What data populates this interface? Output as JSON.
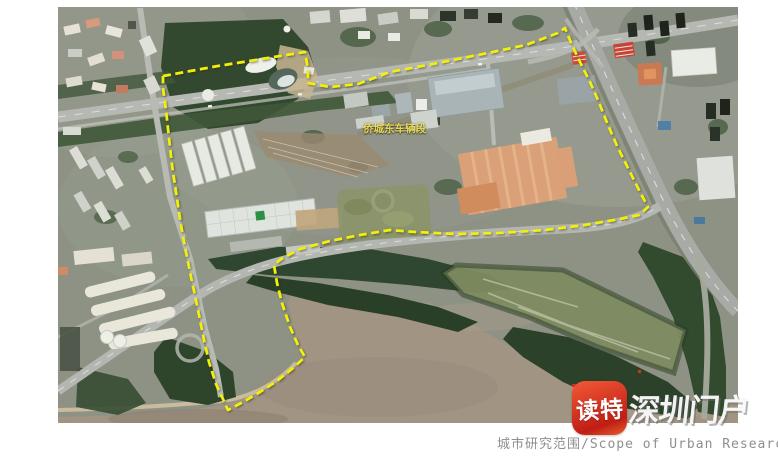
{
  "map": {
    "x": 58,
    "y": 7,
    "width": 680,
    "height": 416,
    "kind": "satellite-imagery",
    "place_label": {
      "text": "侨城东车辆段",
      "color": "#f3e24a"
    }
  },
  "boundary": {
    "label": "城市研究范围",
    "color": "#f2ef0c",
    "stroke_width": 2.8,
    "dash": "8 4.5",
    "points": [
      [
        105,
        69
      ],
      [
        160,
        59
      ],
      [
        210,
        51
      ],
      [
        247,
        45
      ],
      [
        250,
        62
      ],
      [
        250,
        76
      ],
      [
        272,
        80
      ],
      [
        300,
        77
      ],
      [
        332,
        65
      ],
      [
        380,
        56
      ],
      [
        430,
        46
      ],
      [
        468,
        38
      ],
      [
        500,
        26
      ],
      [
        507,
        21
      ],
      [
        514,
        38
      ],
      [
        522,
        55
      ],
      [
        532,
        75
      ],
      [
        540,
        93
      ],
      [
        550,
        118
      ],
      [
        560,
        141
      ],
      [
        572,
        165
      ],
      [
        582,
        185
      ],
      [
        590,
        200
      ],
      [
        581,
        208
      ],
      [
        562,
        212
      ],
      [
        527,
        218
      ],
      [
        487,
        223
      ],
      [
        442,
        226
      ],
      [
        397,
        227
      ],
      [
        357,
        225
      ],
      [
        332,
        223
      ],
      [
        302,
        228
      ],
      [
        272,
        234
      ],
      [
        242,
        242
      ],
      [
        223,
        252
      ],
      [
        216,
        258
      ],
      [
        219,
        276
      ],
      [
        224,
        296
      ],
      [
        232,
        320
      ],
      [
        240,
        338
      ],
      [
        247,
        350
      ],
      [
        235,
        361
      ],
      [
        219,
        374
      ],
      [
        202,
        385
      ],
      [
        185,
        395
      ],
      [
        170,
        403
      ],
      [
        158,
        377
      ],
      [
        151,
        355
      ],
      [
        146,
        333
      ],
      [
        142,
        313
      ],
      [
        138,
        293
      ],
      [
        133,
        270
      ],
      [
        128,
        245
      ],
      [
        124,
        224
      ],
      [
        121,
        205
      ],
      [
        118,
        185
      ],
      [
        114,
        158
      ],
      [
        111,
        131
      ],
      [
        108,
        103
      ],
      [
        105,
        81
      ],
      [
        105,
        69
      ]
    ]
  },
  "watermark": {
    "icon_text": "读特",
    "icon_color_top": "#f25a36",
    "icon_color_bottom": "#c01d15",
    "brand_text": "深圳门户",
    "brand_color": "rgba(255,255,255,0.93)"
  },
  "caption": {
    "text": "城市研究范围/Scope of Urban Research",
    "color": "#8f8f8f"
  }
}
